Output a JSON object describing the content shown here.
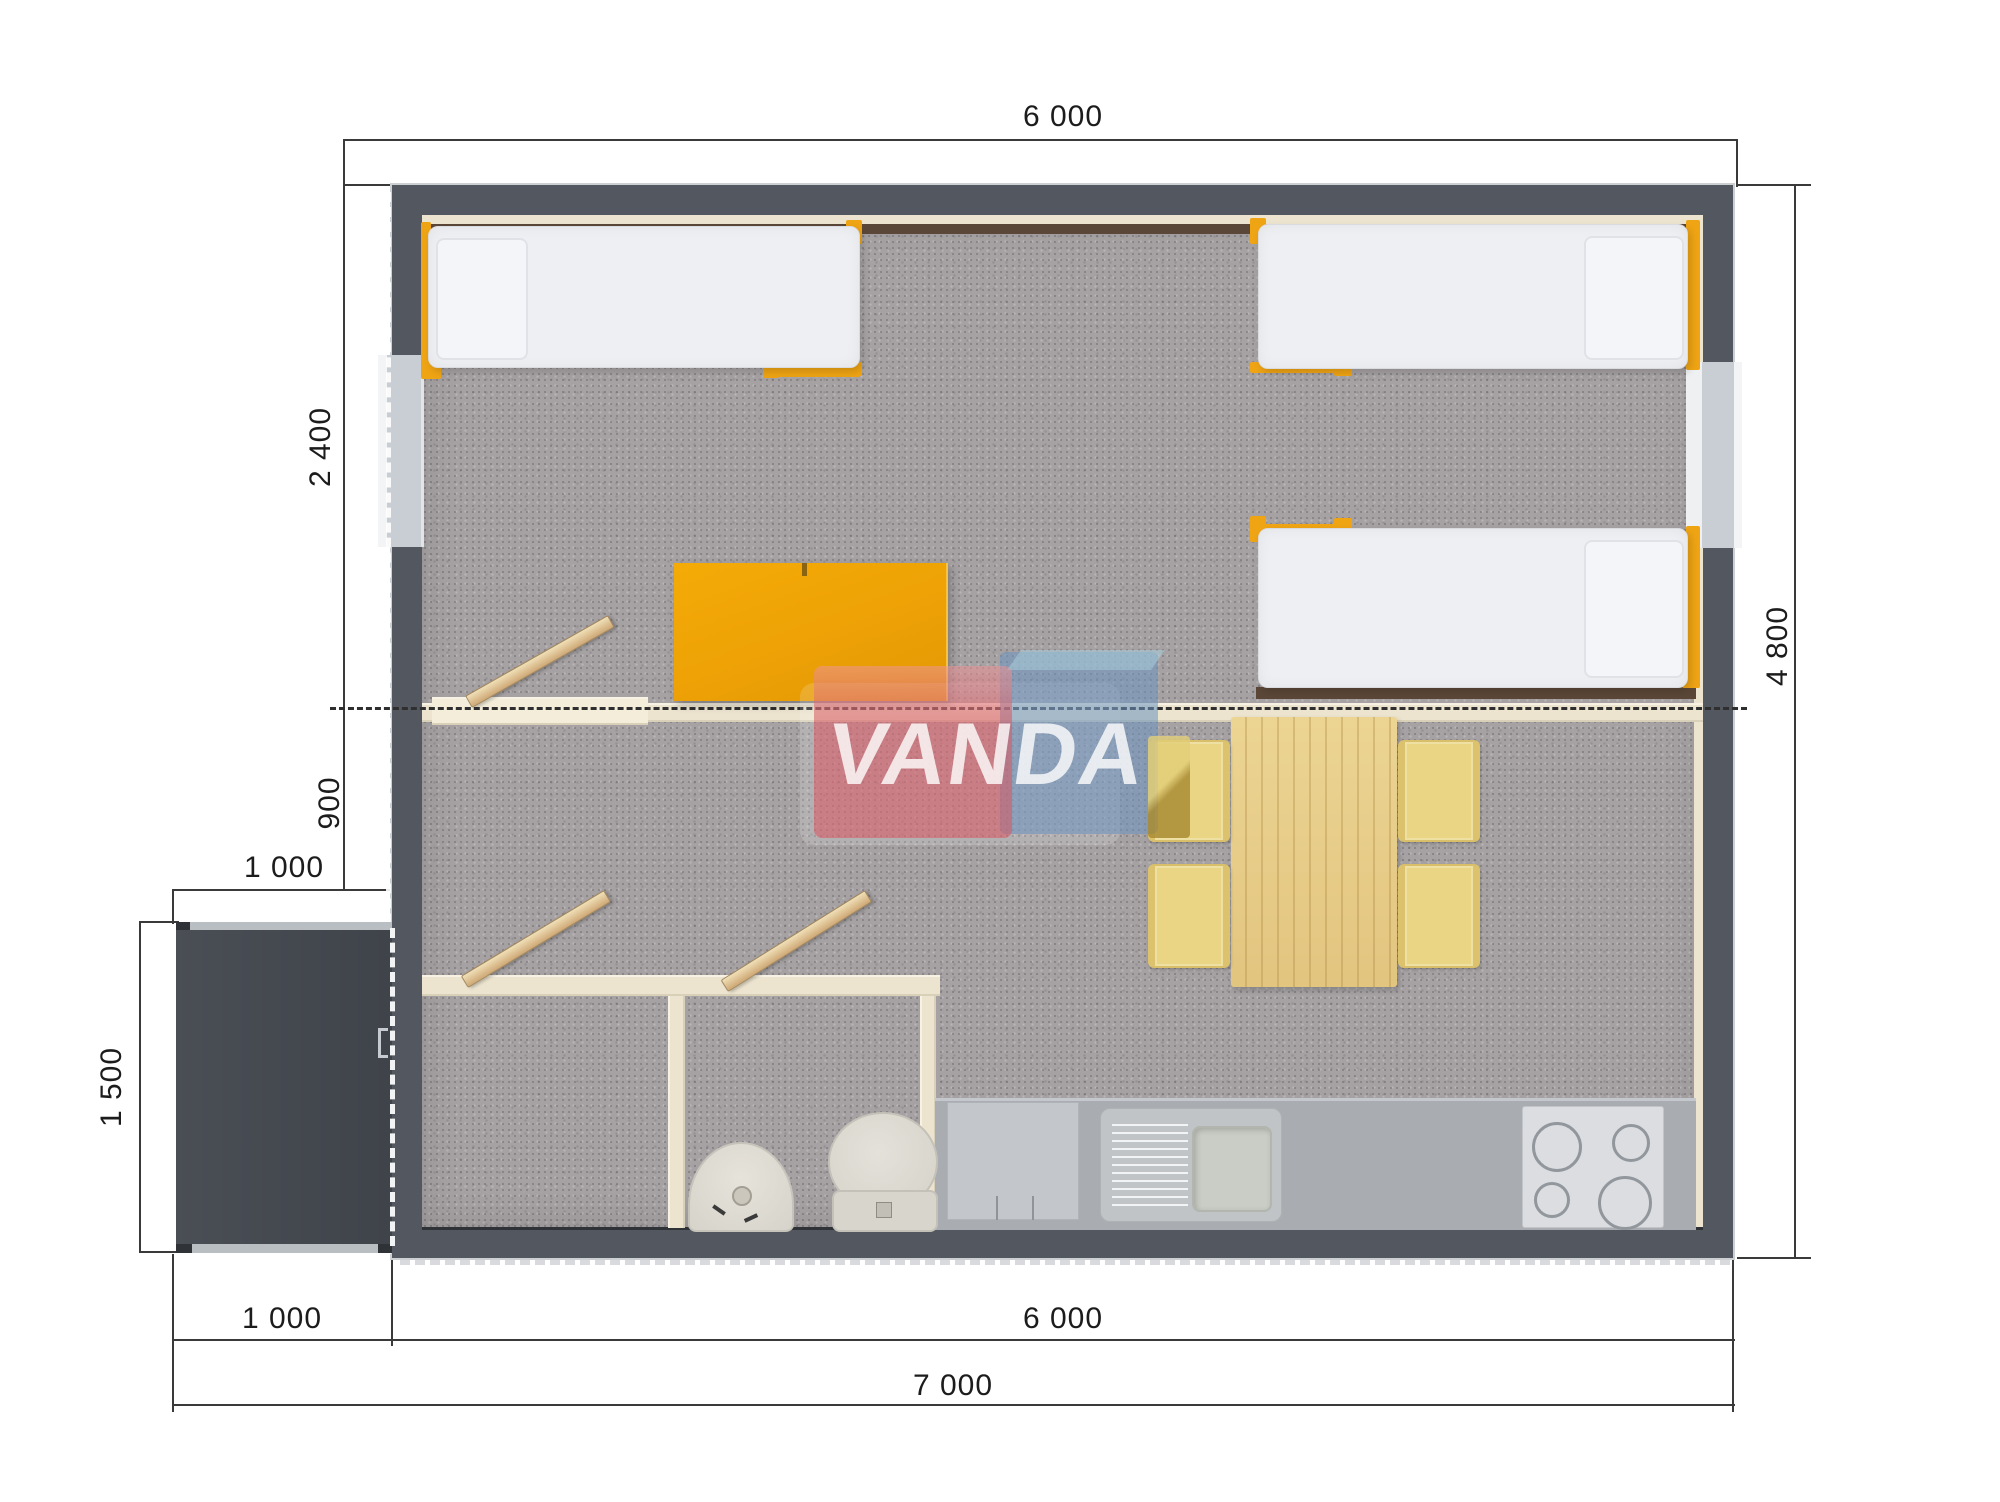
{
  "watermark": {
    "text": "VANDA"
  },
  "dimensions": {
    "top": {
      "house_width": "6 000"
    },
    "left": {
      "bedroom_depth": "2 400",
      "hall_depth": "900",
      "porch_width": "1 000",
      "porch_depth": "1 500"
    },
    "right": {
      "house_depth": "4 800"
    },
    "bottom": {
      "porch_width": "1 000",
      "house_width": "6 000",
      "total_width": "7 000"
    }
  },
  "furniture": [
    "single-bed",
    "single-bed",
    "single-bed",
    "wardrobe",
    "dining-table",
    "chair",
    "chair",
    "chair",
    "chair",
    "kitchen-counter",
    "kitchen-sink",
    "stove",
    "washbasin",
    "toilet",
    "porch-deck",
    "door",
    "door",
    "door"
  ],
  "colors": {
    "wall": "#53575f",
    "floor": "#a6a2a4",
    "partition": "#ece4cf",
    "orange": "#efa414",
    "chair": "#e9d584",
    "porch": "#43474e",
    "counter": "#a9adb2",
    "logo_pink": "#dd626a",
    "logo_blue": "#6c94c0",
    "logo_yellow": "#c2a74a"
  }
}
